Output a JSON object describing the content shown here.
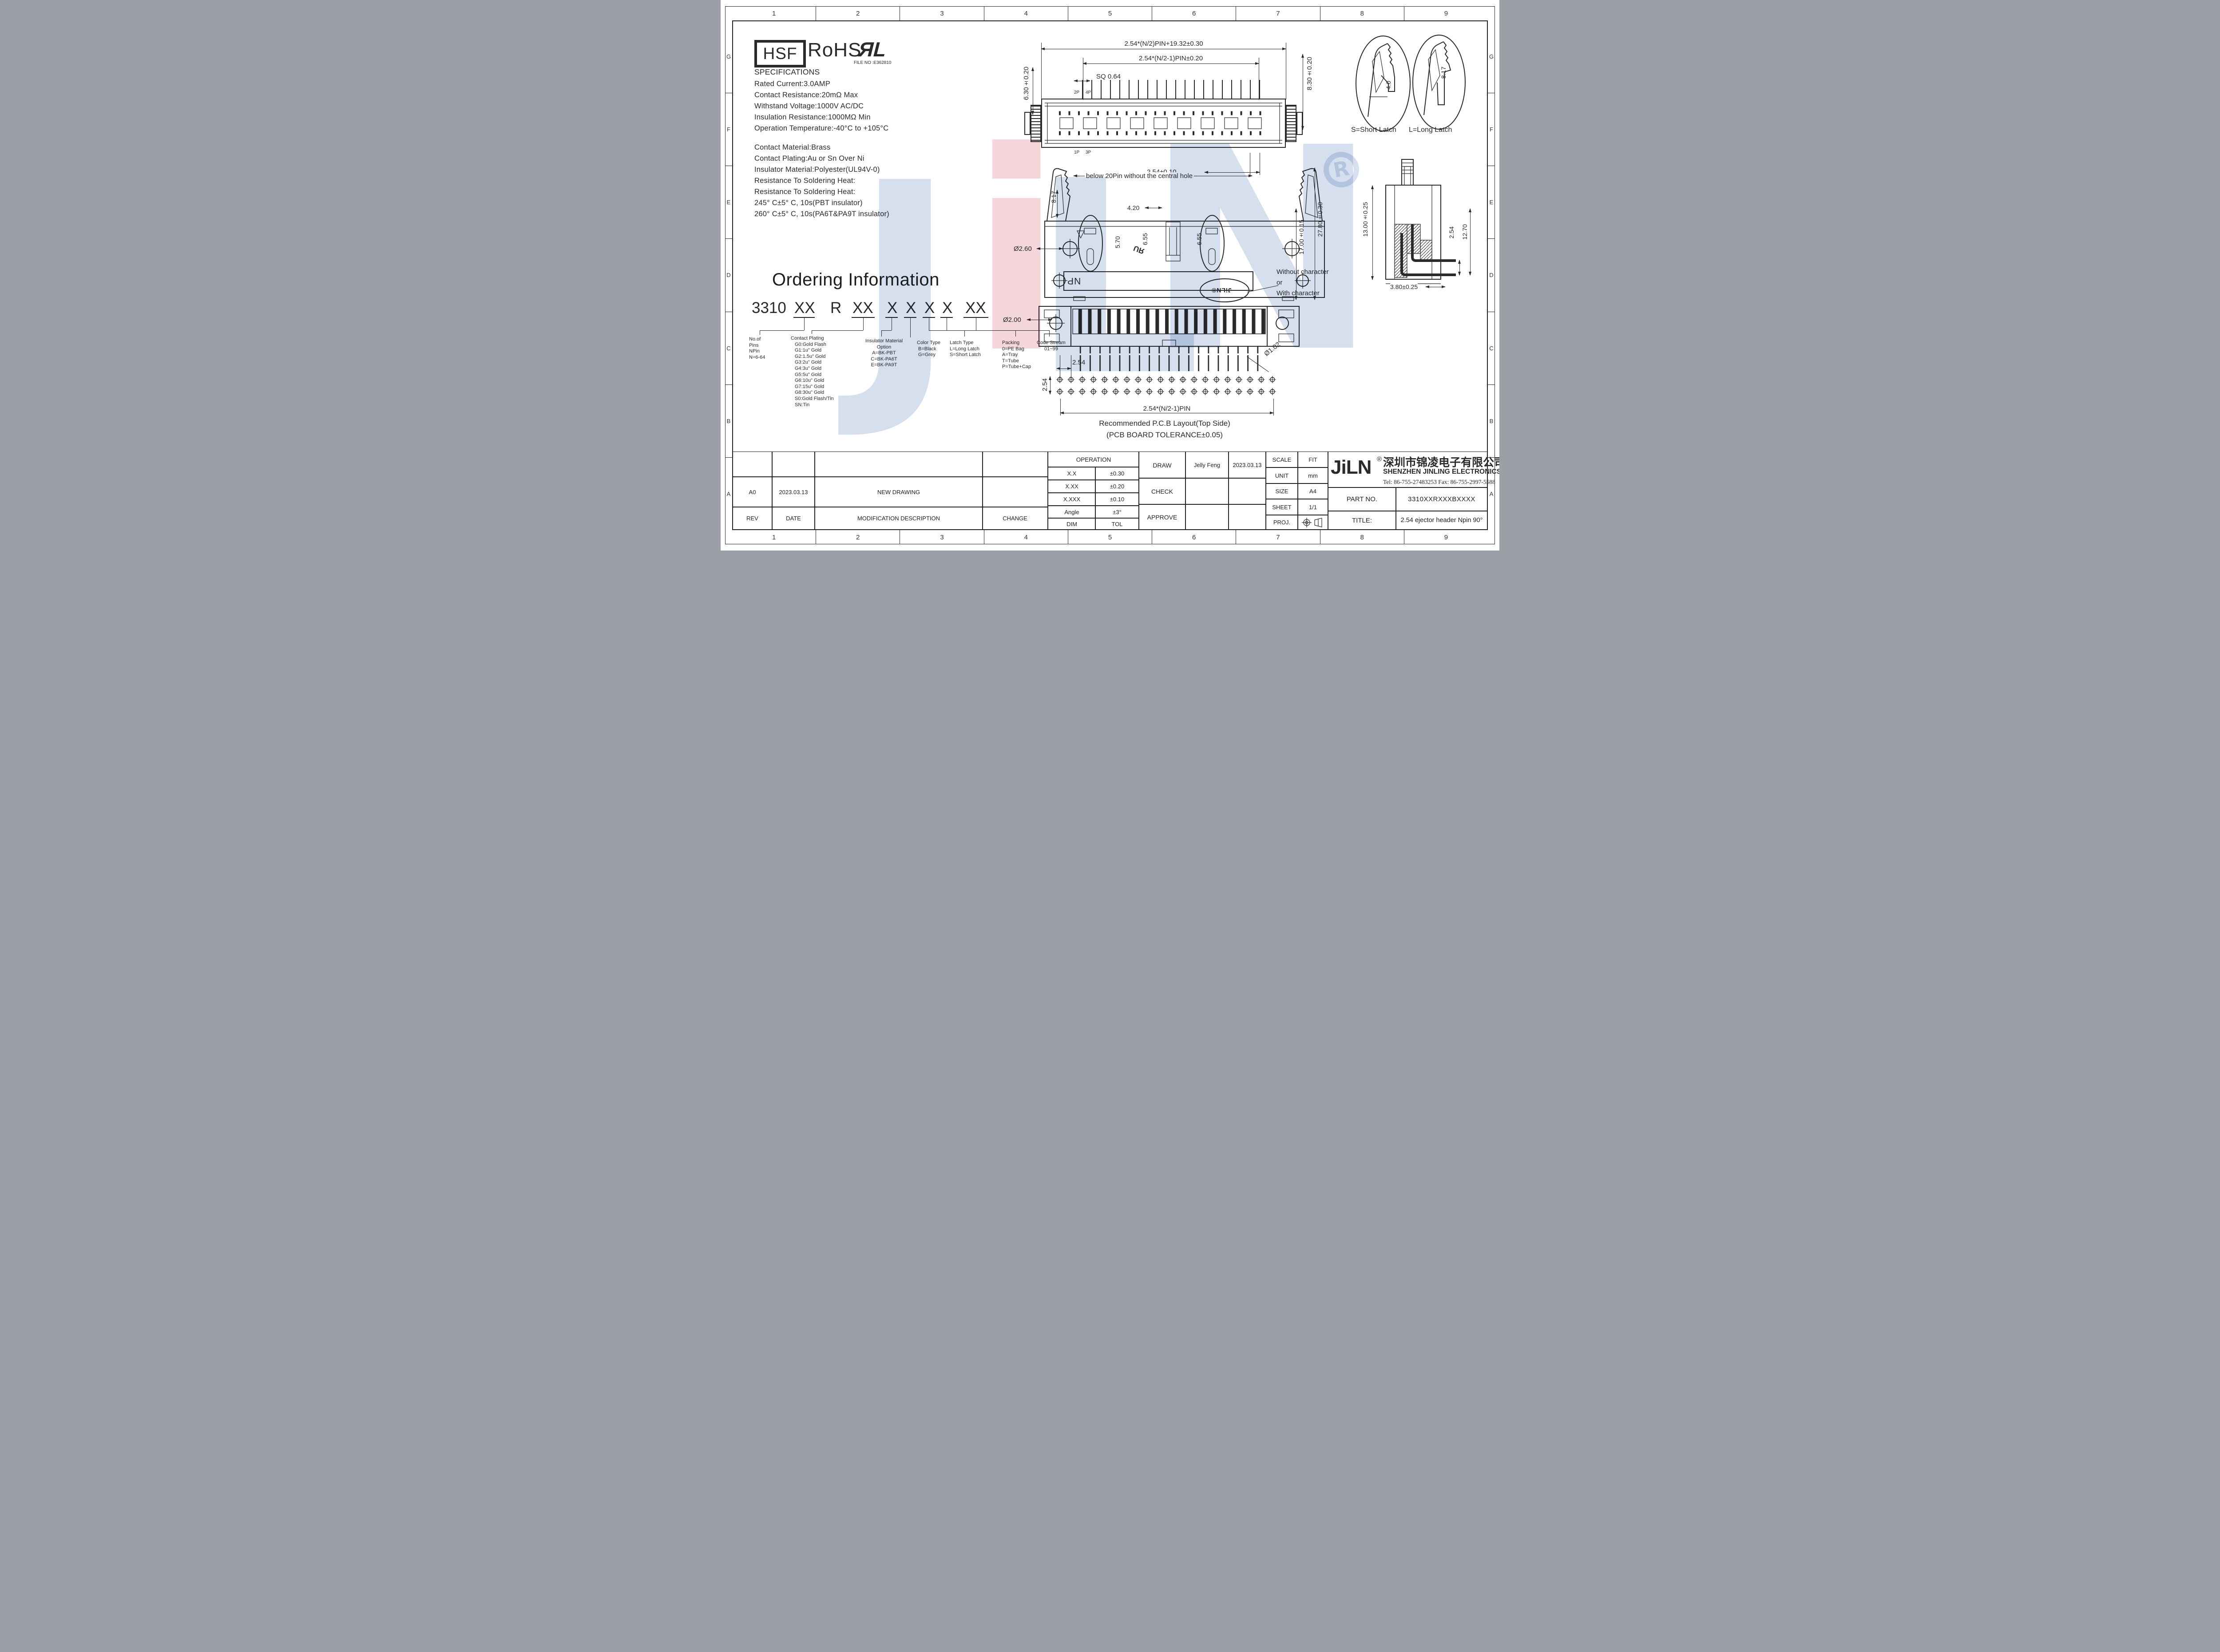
{
  "border": {
    "columns": [
      "1",
      "2",
      "3",
      "4",
      "5",
      "6",
      "7",
      "8",
      "9"
    ],
    "rows": [
      "G",
      "F",
      "E",
      "D",
      "C",
      "B",
      "A"
    ]
  },
  "logos": {
    "hsf": "HSF",
    "rohs": "RoHS",
    "ul_mark": "ЯL",
    "file_no": "FILE NO :E362810"
  },
  "specs": {
    "title": "SPECIFICATIONS",
    "lines": [
      "Rated Current:3.0AMP",
      "Contact Resistance:20mΩ Max",
      "Withstand Voltage:1000V AC/DC",
      "Insulation Resistance:1000MΩ Min",
      "Operation Temperature:-40°C to +105°C"
    ]
  },
  "materials": {
    "lines": [
      "Contact Material:Brass",
      "Contact Plating:Au or Sn Over Ni",
      "Insulator Material:Polyester(UL94V-0)",
      "Resistance To Soldering Heat:",
      "Resistance To Soldering Heat:",
      "245° C±5° C, 10s(PBT insulator)",
      "260° C±5° C, 10s(PA6T&PA9T insulator)"
    ]
  },
  "ordering": {
    "title": "Ordering Information",
    "code": [
      "3310",
      "XX",
      "R",
      "XX",
      "X",
      "X",
      "X",
      "X",
      "XX"
    ],
    "pins": {
      "lines": [
        "No.of",
        "Pins",
        "NPin",
        "N=6-64"
      ]
    },
    "plating": {
      "title": "Contact Plating",
      "options": [
        "G0:Gold Flash",
        "G1:1u\" Gold",
        "G2:1.5u\" Gold",
        "G3:2u\" Gold",
        "G4:3u\" Gold",
        "G5:5u\" Gold",
        "G6:10u\" Gold",
        "G7:15u\" Gold",
        "G8:30u\" Gold",
        "S0:Gold Flash/Tin",
        "SN:Tin"
      ]
    },
    "insulator": {
      "title": "Insulator Material",
      "subtitle": "Option",
      "options": [
        "A=BK-PBT",
        "C=BK-PA6T",
        "E=BK-PA9T"
      ]
    },
    "color": {
      "title": "Color Type",
      "options": [
        "B=Black",
        "G=Grey"
      ]
    },
    "latch": {
      "title": "Latch Type",
      "options": [
        "L=Long Latch",
        "S=Short Latch"
      ]
    },
    "packing": {
      "title": "Packing",
      "options": [
        "0=PE Bag",
        "A=Tray",
        "T=Tube",
        "P=Tube+Cap"
      ]
    },
    "stream": {
      "title": "Code Stream",
      "range": "01~99"
    }
  },
  "top_view": {
    "dim_overall": "2.54*(N/2)PIN+19.32±0.30",
    "dim_span": "2.54*(N/2-1)PIN±0.20",
    "dim_sq": "SQ 0.64",
    "dim_left": "6.30±0.20",
    "dim_right": "8.30±0.20",
    "dim_pitch": "2.54±0.10",
    "p2": "2P",
    "p4": "4P",
    "p1": "1P",
    "p3": "3P"
  },
  "latch_detail": {
    "short_dim": "4.0",
    "long_dim": "8.17",
    "short_label": "S=Short Latch",
    "long_label": "L=Long Latch"
  },
  "front_view": {
    "note": "below 20Pin without the central hole",
    "d817": "8.17",
    "d420": "4.20",
    "d570": "5.70",
    "d655a": "6.55",
    "d655b": "6.55",
    "d1700": "17.00±0.15",
    "d2780": "27.80±0.30",
    "d260": "Ø2.60",
    "np": "NP",
    "stamp": "JiLN®",
    "ul_mirrored": "ЯU",
    "char_note": [
      "Without character",
      "or",
      "With character"
    ]
  },
  "side_view": {
    "d1300": "13.00±0.25",
    "d254": "2.54",
    "d1270": "12.70",
    "d380": "3.80±0.25"
  },
  "bottom_view": {
    "d200": "Ø2.00"
  },
  "pcb": {
    "d254h": "2.54",
    "d254v": "2.54",
    "d102": "Ø1.02",
    "dim_row": "2.54*(N/2-1)PIN",
    "caption1": "Recommended P.C.B Layout(Top Side)",
    "caption2": "(PCB BOARD TOLERANCE±0.05)"
  },
  "title_block": {
    "revision": {
      "rev_value": "A0",
      "date_value": "2023.03.13",
      "desc_value": "NEW DRAWING",
      "rev_label": "REV",
      "date_label": "DATE",
      "desc_label": "MODIFICATION DESCRIPTION",
      "change_label": "CHANGE"
    },
    "tolerance": {
      "header": "OPERATION",
      "rows": [
        [
          "X.X",
          "±0.30"
        ],
        [
          "X.XX",
          "±0.20"
        ],
        [
          "X.XXX",
          "±0.10"
        ],
        [
          "Angle",
          "±3°"
        ],
        [
          "DIM",
          "TOL"
        ]
      ]
    },
    "sign": {
      "draw_label": "DRAW",
      "draw_name": "Jelly Feng",
      "draw_date": "2023.03.13",
      "check_label": "CHECK",
      "approve_label": "APPROVE"
    },
    "meta": {
      "scale_label": "SCALE",
      "scale_value": "FIT",
      "unit_label": "UNIT",
      "unit_value": "mm",
      "size_label": "SIZE",
      "size_value": "A4",
      "sheet_label": "SHEET",
      "sheet_value": "1/1",
      "proj_label": "PROJ."
    },
    "company": {
      "logo": "JiLN",
      "reg": "®",
      "cn": "深圳市锦凌电子有限公司",
      "en": "SHENZHEN JINLING ELECTRONICS CO.,LTD",
      "tel": "Tel: 86-755-27483253 Fax: 86-755-2997-5588",
      "part_label": "PART NO.",
      "part_value": "3310XXRXXXBXXXX",
      "title_label": "TITLE:",
      "title_value": "2.54 ejector header Npin 90°"
    }
  },
  "watermark": {
    "j": "J",
    "i": "i",
    "l": "L",
    "n": "N",
    "reg": "R"
  }
}
